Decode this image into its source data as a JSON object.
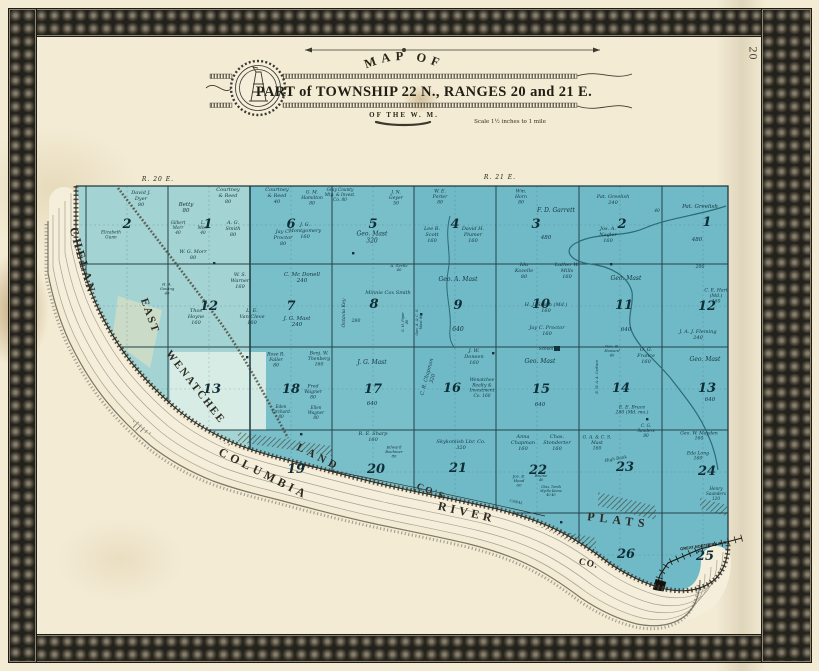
{
  "page": {
    "number": "20"
  },
  "title": {
    "arc_text": "MAP OF",
    "main": "PART of TOWNSHIP 22 N., RANGES 20 and 21 E.",
    "sub": "OF THE W. M.",
    "scale": "Scale 1½ inches to 1 mile"
  },
  "colors": {
    "paper": "#f3ebd4",
    "water_band": "#f4eedb",
    "land_blue": "#79bfca",
    "ink": "#14333c",
    "border": "#2f2d26"
  },
  "map": {
    "range_labels": [
      {
        "t": [
          "R. 20 E."
        ],
        "x": 158,
        "y": 181,
        "fs": 6,
        "ls": 1
      },
      {
        "t": [
          "R. 21 E."
        ],
        "x": 500,
        "y": 179,
        "fs": 6,
        "ls": 1
      }
    ],
    "section_numbers": [
      [
        2,
        127,
        228
      ],
      [
        1,
        208,
        228
      ],
      [
        6,
        291,
        228
      ],
      [
        5,
        373,
        228
      ],
      [
        4,
        455,
        228
      ],
      [
        3,
        536,
        228
      ],
      [
        2,
        622,
        228
      ],
      [
        1,
        707,
        226
      ],
      [
        12,
        209,
        310
      ],
      [
        7,
        291,
        310
      ],
      [
        8,
        374,
        308
      ],
      [
        9,
        458,
        309
      ],
      [
        10,
        541,
        308
      ],
      [
        11,
        624,
        309
      ],
      [
        12,
        707,
        310
      ],
      [
        13,
        212,
        393
      ],
      [
        18,
        291,
        393
      ],
      [
        17,
        373,
        393
      ],
      [
        16,
        452,
        392
      ],
      [
        15,
        541,
        393
      ],
      [
        14,
        621,
        392
      ],
      [
        13,
        707,
        392
      ],
      [
        19,
        296,
        473
      ],
      [
        20,
        376,
        473
      ],
      [
        21,
        458,
        472
      ],
      [
        22,
        538,
        474
      ],
      [
        23,
        625,
        471
      ],
      [
        24,
        707,
        475
      ],
      [
        26,
        626,
        558
      ],
      [
        25,
        705,
        560
      ]
    ],
    "parcel_labels": [
      {
        "t": [
          "David J.",
          "Dyer",
          "80"
        ],
        "x": 141,
        "y": 200,
        "fs": 5
      },
      {
        "t": [
          "Elizabeth",
          "Gunn"
        ],
        "x": 111,
        "y": 236,
        "fs": 4.2
      },
      {
        "t": [
          "Betty",
          "80"
        ],
        "x": 186,
        "y": 209,
        "fs": 5.5
      },
      {
        "t": [
          "Gilbert",
          "Morr",
          "40"
        ],
        "x": 178,
        "y": 229,
        "fs": 4.2
      },
      {
        "t": [
          "L.",
          "Morr",
          "40"
        ],
        "x": 203,
        "y": 229,
        "fs": 4.2
      },
      {
        "t": [
          "W. G. Morr",
          "80"
        ],
        "x": 193,
        "y": 256,
        "fs": 5
      },
      {
        "t": [
          "A. G.",
          "Smith",
          "80"
        ],
        "x": 233,
        "y": 230,
        "fs": 5
      },
      {
        "t": [
          "Courtney",
          "& Reed",
          "80"
        ],
        "x": 228,
        "y": 197,
        "fs": 5
      },
      {
        "t": [
          "Courtney",
          "& Reed",
          "40"
        ],
        "x": 277,
        "y": 197,
        "fs": 5
      },
      {
        "t": [
          "Jay C.",
          "Proctor",
          "80"
        ],
        "x": 283,
        "y": 239,
        "fs": 5
      },
      {
        "t": [
          "W. S.",
          "Warner",
          "160"
        ],
        "x": 240,
        "y": 282,
        "fs": 5
      },
      {
        "t": [
          "H. A.",
          "Gosling",
          "40"
        ],
        "x": 167,
        "y": 290,
        "fs": 3.8
      },
      {
        "t": [
          "Thos",
          "Hoyne",
          "160"
        ],
        "x": 196,
        "y": 318,
        "fs": 5
      },
      {
        "t": [
          "L. E.",
          "Van Cleve",
          "160"
        ],
        "x": 252,
        "y": 318,
        "fs": 5
      },
      {
        "t": [
          "G. M.",
          "Hamilton",
          "80"
        ],
        "x": 312,
        "y": 199,
        "fs": 4.6
      },
      {
        "t": [
          "Gray County",
          "Mtg. & Invest.",
          "Co.  80"
        ],
        "x": 340,
        "y": 196,
        "fs": 4.2
      },
      {
        "t": [
          "J. N.",
          "Geyer",
          "50"
        ],
        "x": 396,
        "y": 199,
        "fs": 4.6
      },
      {
        "t": [
          "J. G.",
          "Montgomery",
          "160"
        ],
        "x": 305,
        "y": 232,
        "fs": 5
      },
      {
        "t": [
          "Geo. Mast",
          "320"
        ],
        "x": 372,
        "y": 239,
        "fs": 6
      },
      {
        "t": [
          "W. E.",
          "Porter",
          "80"
        ],
        "x": 440,
        "y": 198,
        "fs": 4.6
      },
      {
        "t": [
          "Lee B.",
          "Scott",
          "160"
        ],
        "x": 432,
        "y": 236,
        "fs": 5
      },
      {
        "t": [
          "David H.",
          "Plumer",
          "160"
        ],
        "x": 473,
        "y": 236,
        "fs": 5
      },
      {
        "t": [
          "Wm.",
          "Horn",
          "80"
        ],
        "x": 521,
        "y": 198,
        "fs": 4.6
      },
      {
        "t": [
          "F. D. Garrett"
        ],
        "x": 556,
        "y": 212,
        "fs": 6
      },
      {
        "t": [
          "480"
        ],
        "x": 546,
        "y": 239,
        "fs": 5.5
      },
      {
        "t": [
          "Pat. Greelish",
          "240"
        ],
        "x": 613,
        "y": 201,
        "fs": 5
      },
      {
        "t": [
          "40"
        ],
        "x": 657,
        "y": 212,
        "fs": 4.2
      },
      {
        "t": [
          "Jos. A.",
          "Nagler",
          "160"
        ],
        "x": 608,
        "y": 236,
        "fs": 5
      },
      {
        "t": [
          "Pat. Greelish"
        ],
        "x": 700,
        "y": 208,
        "fs": 5.5
      },
      {
        "t": [
          "480"
        ],
        "x": 697,
        "y": 241,
        "fs": 5.5
      },
      {
        "t": [
          "C. Mc Donell",
          "240"
        ],
        "x": 302,
        "y": 279,
        "fs": 5.5
      },
      {
        "t": [
          "J. G. Mast",
          "240"
        ],
        "x": 297,
        "y": 323,
        "fs": 5.5
      },
      {
        "t": [
          "Octavia Key"
        ],
        "x": 345,
        "y": 313,
        "fs": 4.8,
        "rot": -90
      },
      {
        "t": [
          "280"
        ],
        "x": 356,
        "y": 322,
        "fs": 4.6
      },
      {
        "t": [
          "Minnie Cox Smith"
        ],
        "x": 388,
        "y": 294,
        "fs": 5
      },
      {
        "t": [
          "A. Gertle",
          "40"
        ],
        "x": 399,
        "y": 269,
        "fs": 3.8
      },
      {
        "t": [
          "S. H. Piper",
          "40"
        ],
        "x": 406,
        "y": 322,
        "fs": 3.6,
        "rot": -90
      },
      {
        "t": [
          "Geo. A. & C. S.",
          "Mast  80"
        ],
        "x": 420,
        "y": 322,
        "fs": 3.6,
        "rot": -90
      },
      {
        "t": [
          "Geo. A. Mast"
        ],
        "x": 458,
        "y": 281,
        "fs": 6
      },
      {
        "t": [
          "640"
        ],
        "x": 458,
        "y": 331,
        "fs": 6
      },
      {
        "t": [
          "Ida",
          "Kozelle",
          "80"
        ],
        "x": 524,
        "y": 272,
        "fs": 5
      },
      {
        "t": [
          "Luther W.",
          "Mills",
          "160"
        ],
        "x": 567,
        "y": 272,
        "fs": 5
      },
      {
        "t": [
          "H. J. Smith (Md.)",
          "160"
        ],
        "x": 546,
        "y": 309,
        "fs": 5
      },
      {
        "t": [
          "Jay C. Proctor",
          "160"
        ],
        "x": 547,
        "y": 332,
        "fs": 5
      },
      {
        "t": [
          "Geo. Mast"
        ],
        "x": 626,
        "y": 280,
        "fs": 6
      },
      {
        "t": [
          "640"
        ],
        "x": 626,
        "y": 331,
        "fs": 5.5
      },
      {
        "t": [
          "200"
        ],
        "x": 700,
        "y": 268,
        "fs": 4.6
      },
      {
        "t": [
          "C. E. Hart",
          "(Md.)",
          "160"
        ],
        "x": 716,
        "y": 297,
        "fs": 4.6
      },
      {
        "t": [
          "J. A. J. Fleming",
          "240"
        ],
        "x": 698,
        "y": 336,
        "fs": 5
      },
      {
        "t": [
          "Rose R.",
          "Faller",
          "80"
        ],
        "x": 276,
        "y": 361,
        "fs": 4.6
      },
      {
        "t": [
          "Benj. W.",
          "Thenberg",
          "160"
        ],
        "x": 319,
        "y": 360,
        "fs": 4.6
      },
      {
        "t": [
          "Fred",
          "Wagner",
          "80"
        ],
        "x": 313,
        "y": 393,
        "fs": 4.6
      },
      {
        "t": [
          "Eden",
          "Orchard",
          "80"
        ],
        "x": 281,
        "y": 413,
        "fs": 4.2
      },
      {
        "t": [
          "Ellen",
          "Wagner",
          "80"
        ],
        "x": 316,
        "y": 414,
        "fs": 4.2
      },
      {
        "t": [
          "J. G. Mast"
        ],
        "x": 372,
        "y": 364,
        "fs": 6
      },
      {
        "t": [
          "640"
        ],
        "x": 372,
        "y": 405,
        "fs": 5.5
      },
      {
        "t": [
          "C. R. Chapman",
          "320"
        ],
        "x": 431,
        "y": 378,
        "fs": 5,
        "rot": -75
      },
      {
        "t": [
          "J. W.",
          "Doneen",
          "160"
        ],
        "x": 474,
        "y": 358,
        "fs": 5
      },
      {
        "t": [
          "Wenatchee",
          "Realty &",
          "Investment",
          "Co.  160"
        ],
        "x": 482,
        "y": 389,
        "fs": 4.4
      },
      {
        "t": [
          "Geo. Mast"
        ],
        "x": 540,
        "y": 363,
        "fs": 6
      },
      {
        "t": [
          "640"
        ],
        "x": 540,
        "y": 406,
        "fs": 5.5
      },
      {
        "t": [
          "School"
        ],
        "x": 546,
        "y": 350,
        "fs": 4.2
      },
      {
        "t": [
          "Geo. B.",
          "Howard",
          "40"
        ],
        "x": 612,
        "y": 352,
        "fs": 3.8
      },
      {
        "t": [
          "O. G.",
          "France",
          "160"
        ],
        "x": 646,
        "y": 357,
        "fs": 5
      },
      {
        "t": [
          "E. W. & A. Carlson"
        ],
        "x": 598,
        "y": 377,
        "fs": 3.6,
        "rot": -90
      },
      {
        "t": [
          "E. E. Bruce",
          "280  (Md. mo.)"
        ],
        "x": 632,
        "y": 411,
        "fs": 4.6
      },
      {
        "t": [
          "Geo. Mast"
        ],
        "x": 705,
        "y": 361,
        "fs": 6
      },
      {
        "t": [
          "640"
        ],
        "x": 710,
        "y": 401,
        "fs": 5.5
      },
      {
        "t": [
          "R. E. Sharp",
          "160"
        ],
        "x": 373,
        "y": 438,
        "fs": 5
      },
      {
        "t": [
          "Edward",
          "Boehmer",
          "80"
        ],
        "x": 394,
        "y": 453,
        "fs": 3.8
      },
      {
        "t": [
          "Skykomish Lbr. Co.",
          "320"
        ],
        "x": 461,
        "y": 446,
        "fs": 5
      },
      {
        "t": [
          "Anna",
          "Chapman",
          "160"
        ],
        "x": 523,
        "y": 444,
        "fs": 5
      },
      {
        "t": [
          "Chas.",
          "Stonderter",
          "160"
        ],
        "x": 557,
        "y": 444,
        "fs": 5
      },
      {
        "t": [
          "Jos. E.",
          "Hood",
          "60"
        ],
        "x": 519,
        "y": 482,
        "fs": 4
      },
      {
        "t": [
          "W.",
          "Bourne",
          "40"
        ],
        "x": 541,
        "y": 477,
        "fs": 3.4
      },
      {
        "t": [
          "Chas. Tarvik",
          "Myrtle Keene",
          "40      40"
        ],
        "x": 551,
        "y": 492,
        "fs": 3.2
      },
      {
        "t": [
          "G. A. & C. S.",
          "Mast",
          "160"
        ],
        "x": 597,
        "y": 444,
        "fs": 4.6
      },
      {
        "t": [
          "C. G.",
          "Sanders",
          "80"
        ],
        "x": 646,
        "y": 432,
        "fs": 4.2
      },
      {
        "t": [
          "High Bank"
        ],
        "x": 616,
        "y": 460,
        "fs": 4.2,
        "rot": -10
      },
      {
        "t": [
          "Geo. W. Mayden",
          "160"
        ],
        "x": 699,
        "y": 437,
        "fs": 4.6
      },
      {
        "t": [
          "Eda Long",
          "160"
        ],
        "x": 698,
        "y": 457,
        "fs": 4.6
      },
      {
        "t": [
          "Henry",
          "Saunders",
          "120"
        ],
        "x": 716,
        "y": 495,
        "fs": 4.2
      },
      {
        "t": [
          "CANAL"
        ],
        "x": 516,
        "y": 503,
        "fs": 3.6,
        "rot": 12
      },
      {
        "t": [
          "GREAT NORTHERN R. R."
        ],
        "x": 704,
        "y": 547,
        "fs": 4,
        "rot": -8,
        "cls": "rr"
      }
    ],
    "water_labels": [
      {
        "t": [
          "CHELAN"
        ],
        "x": 79,
        "y": 262,
        "fs": 12,
        "ls": 3,
        "rot": 74
      },
      {
        "t": [
          "EAST"
        ],
        "x": 147,
        "y": 317,
        "fs": 11,
        "ls": 2,
        "rot": 70
      },
      {
        "t": [
          "WENATCHEE"
        ],
        "x": 193,
        "y": 389,
        "fs": 11,
        "ls": 2,
        "rot": 52
      },
      {
        "t": [
          "LAND"
        ],
        "x": 317,
        "y": 460,
        "fs": 11,
        "ls": 4,
        "rot": 27
      },
      {
        "t": [
          "COLUMBIA"
        ],
        "x": 262,
        "y": 477,
        "fs": 12,
        "ls": 4,
        "rot": 27
      },
      {
        "t": [
          "CO'S"
        ],
        "x": 430,
        "y": 494,
        "fs": 9.5,
        "ls": 2,
        "rot": 22
      },
      {
        "t": [
          "RIVER"
        ],
        "x": 466,
        "y": 516,
        "fs": 12,
        "ls": 4,
        "rot": 13
      },
      {
        "t": [
          "PLATS"
        ],
        "x": 618,
        "y": 524,
        "fs": 12,
        "ls": 5,
        "rot": 7
      },
      {
        "t": [
          "CO."
        ],
        "x": 588,
        "y": 566,
        "fs": 9.5,
        "ls": 1,
        "rot": 12
      }
    ],
    "house_markers": [
      [
        556,
        348
      ],
      [
        352,
        252
      ],
      [
        300,
        433
      ],
      [
        610,
        263
      ],
      [
        492,
        352
      ],
      [
        560,
        521
      ],
      [
        420,
        313
      ],
      [
        646,
        418
      ],
      [
        213,
        262
      ],
      [
        246,
        356
      ]
    ]
  }
}
